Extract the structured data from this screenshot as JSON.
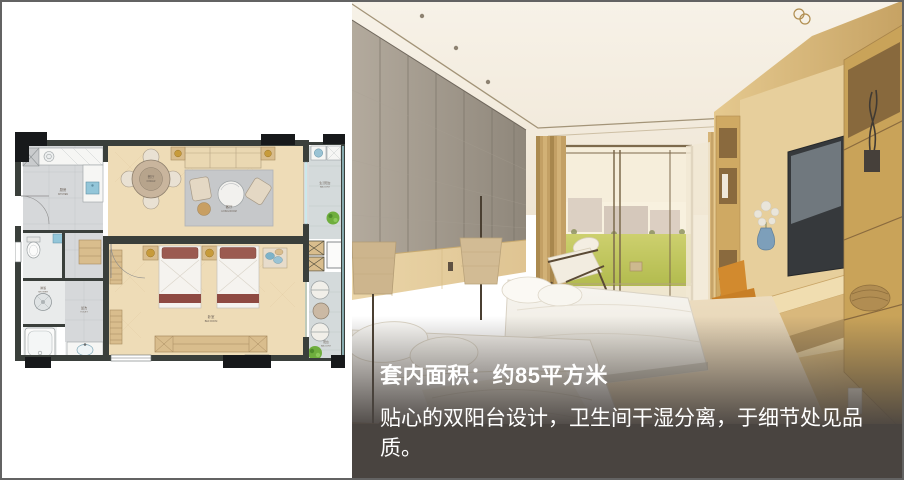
{
  "overlay": {
    "title": "套内面积：约85平方米",
    "description": "贴心的双阳台设计，卫生间干湿分离，于细节处见品质。",
    "panel_color": "#494440",
    "text_color": "#ffffff"
  },
  "floorplan": {
    "rooms": [
      {
        "id": "kitchen",
        "label_cn": "厨房",
        "label_en": "KITCHEN"
      },
      {
        "id": "dining",
        "label_cn": "餐厅",
        "label_en": "DINNER"
      },
      {
        "id": "living",
        "label_cn": "客厅",
        "label_en": "LIVING ROOM"
      },
      {
        "id": "bedroom",
        "label_cn": "卧室",
        "label_en": "BED ROOM"
      },
      {
        "id": "shower",
        "label_cn": "淋浴",
        "label_en": "SHOWER"
      },
      {
        "id": "washroom",
        "label_cn": "盥洗",
        "label_en": "TOILET"
      },
      {
        "id": "service-balcony",
        "label_cn": "生活阳台",
        "label_en": "BALCONY"
      },
      {
        "id": "balcony",
        "label_cn": "阳台",
        "label_en": "BALCONY"
      }
    ],
    "colors": {
      "wall": "#3a3f3b",
      "column_block": "#17191b",
      "wood_floor": "#eedcb7",
      "tile": "#d6d8da",
      "balcony_tile": "#d4dadb",
      "rug": "#c6c8ca",
      "bed_accent": "#8e4a42",
      "cabinet_tan": "#d9bd8d",
      "sink_blue": "#93c6d9",
      "lamp_gold": "#c79b3b",
      "plant_green": "#6fae3e"
    }
  },
  "photo_palette": {
    "stone_wall": "#a09888",
    "oak_cabinet": "#d9ba7f",
    "curtain": "#c3a065",
    "lawn": "#c0c65c",
    "chair_orange": "#d28a2e",
    "bedding": "#f6f3ee"
  }
}
